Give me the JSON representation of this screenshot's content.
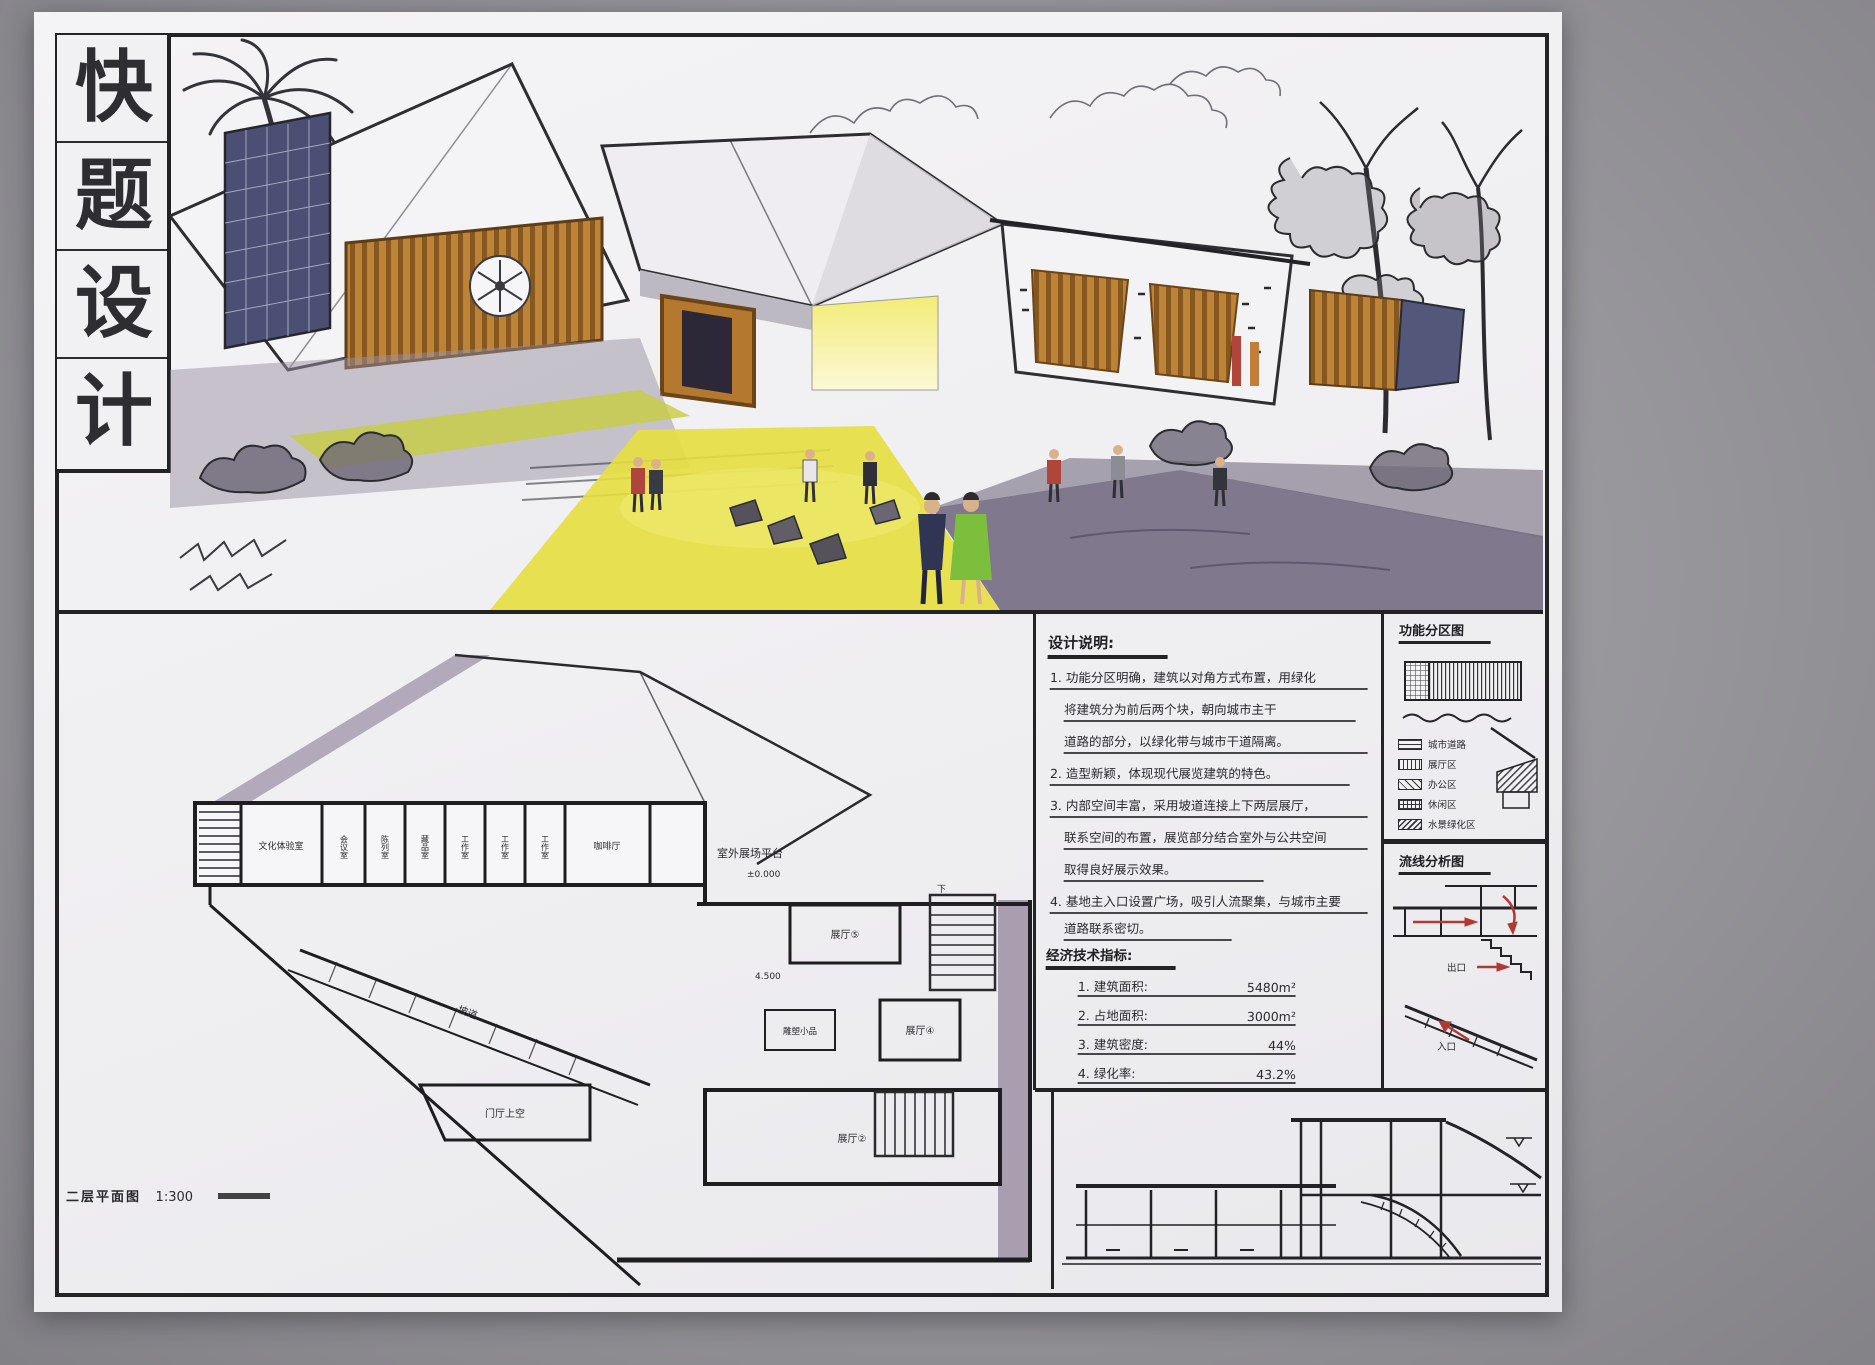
{
  "colors": {
    "paper": "#f2f1f3",
    "ink": "#232326",
    "timber_orange": "#bd8339",
    "glass_blue": "#4a4f73",
    "figure_green": "#7cbf3c",
    "path_yellow": "#e6df3f",
    "shadow_purple": "#9b93a4",
    "poche_purple": "#a89eaf",
    "arrow_red": "#b03a33"
  },
  "title_block": {
    "chars": [
      "快",
      "题",
      "设",
      "计"
    ]
  },
  "notes": {
    "heading": "设计说明:",
    "lines": [
      "1. 功能分区明确，建筑以对角方式布置，用绿化",
      "将建筑分为前后两个块，朝向城市主干",
      "道路的部分，以绿化带与城市干道隔离。",
      "2. 造型新颖，体现现代展览建筑的特色。",
      "3. 内部空间丰富，采用坡道连接上下两层展厅，",
      "联系空间的布置，展览部分结合室外与公共空间",
      "取得良好展示效果。",
      "4. 基地主入口设置广场，吸引人流聚集，与城市主要",
      "道路联系密切。"
    ]
  },
  "indicators": {
    "heading": "经济技术指标:",
    "items": [
      {
        "label": "1. 建筑面积:",
        "value": "5480m²"
      },
      {
        "label": "2. 占地面积:",
        "value": "3000m²"
      },
      {
        "label": "3. 建筑密度:",
        "value": "44%"
      },
      {
        "label": "4. 绿化率:",
        "value": "43.2%"
      }
    ]
  },
  "zoning": {
    "heading": "功能分区图",
    "legend": [
      "城市道路",
      "展厅区",
      "办公区",
      "休闲区",
      "水景绿化区"
    ]
  },
  "circulation": {
    "heading": "流线分析图",
    "exit_label": "出口",
    "entry_label": "入口"
  },
  "floor_plan": {
    "caption": "二层平面图",
    "scale": "1:300",
    "rooms": [
      "文化体验室",
      "会议室",
      "陈列室",
      "藏品室",
      "工作室",
      "工作室",
      "工作室",
      "咖啡厅"
    ],
    "labels": {
      "terrace": "室外展场平台",
      "level_zero": "±0.000",
      "level_up": "4.500",
      "hall5": "展厅⑤",
      "hall4": "展厅④",
      "sculpture": "雕塑小品",
      "lobby_void": "门厅上空",
      "hall2": "展厅②",
      "ramp": "坡道",
      "down": "下"
    }
  }
}
